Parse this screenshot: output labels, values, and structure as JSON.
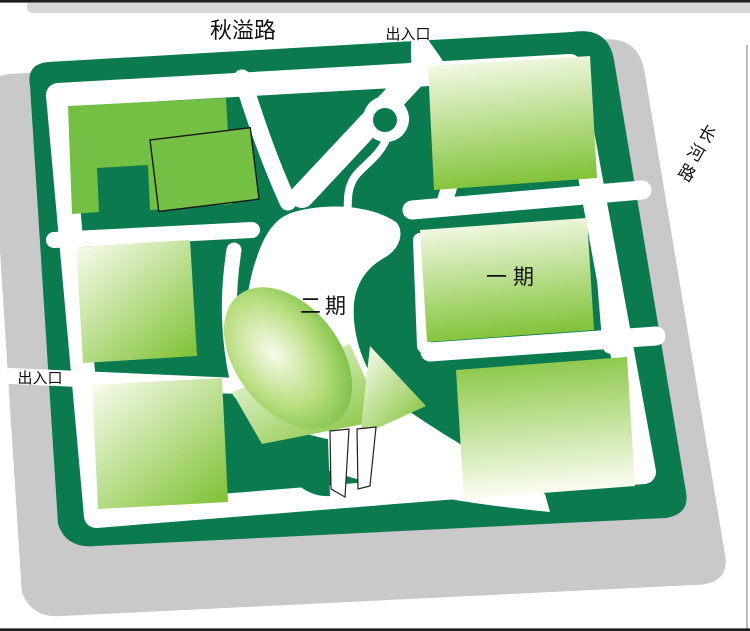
{
  "map": {
    "type": "site-plan",
    "labels": {
      "qiuyi_road": "秋溢路",
      "changhe_road": "长河路",
      "changhe_chars": [
        "长",
        "河",
        "路"
      ],
      "exit_top": "出入口",
      "exit_left": "出入口",
      "phase1": "一期",
      "phase2": "二期"
    },
    "colors": {
      "dark_green": "#0b7b4f",
      "bright_green": "#74c044",
      "grad_light": "#fbfdf2",
      "grad_green": "#84c43c",
      "radial_center": "#f7fbea",
      "radial_mid": "#b9de80",
      "radial_edge": "#62b22b",
      "shadow_gray": "#c9c9c9",
      "strip_gray": "#d6d6d6",
      "edge_line": "#1c1c1c",
      "thin_line": "#9e9e9e",
      "road_white": "#ffffff",
      "text_black": "#111111",
      "pier_white": "#fdfdfd"
    }
  }
}
